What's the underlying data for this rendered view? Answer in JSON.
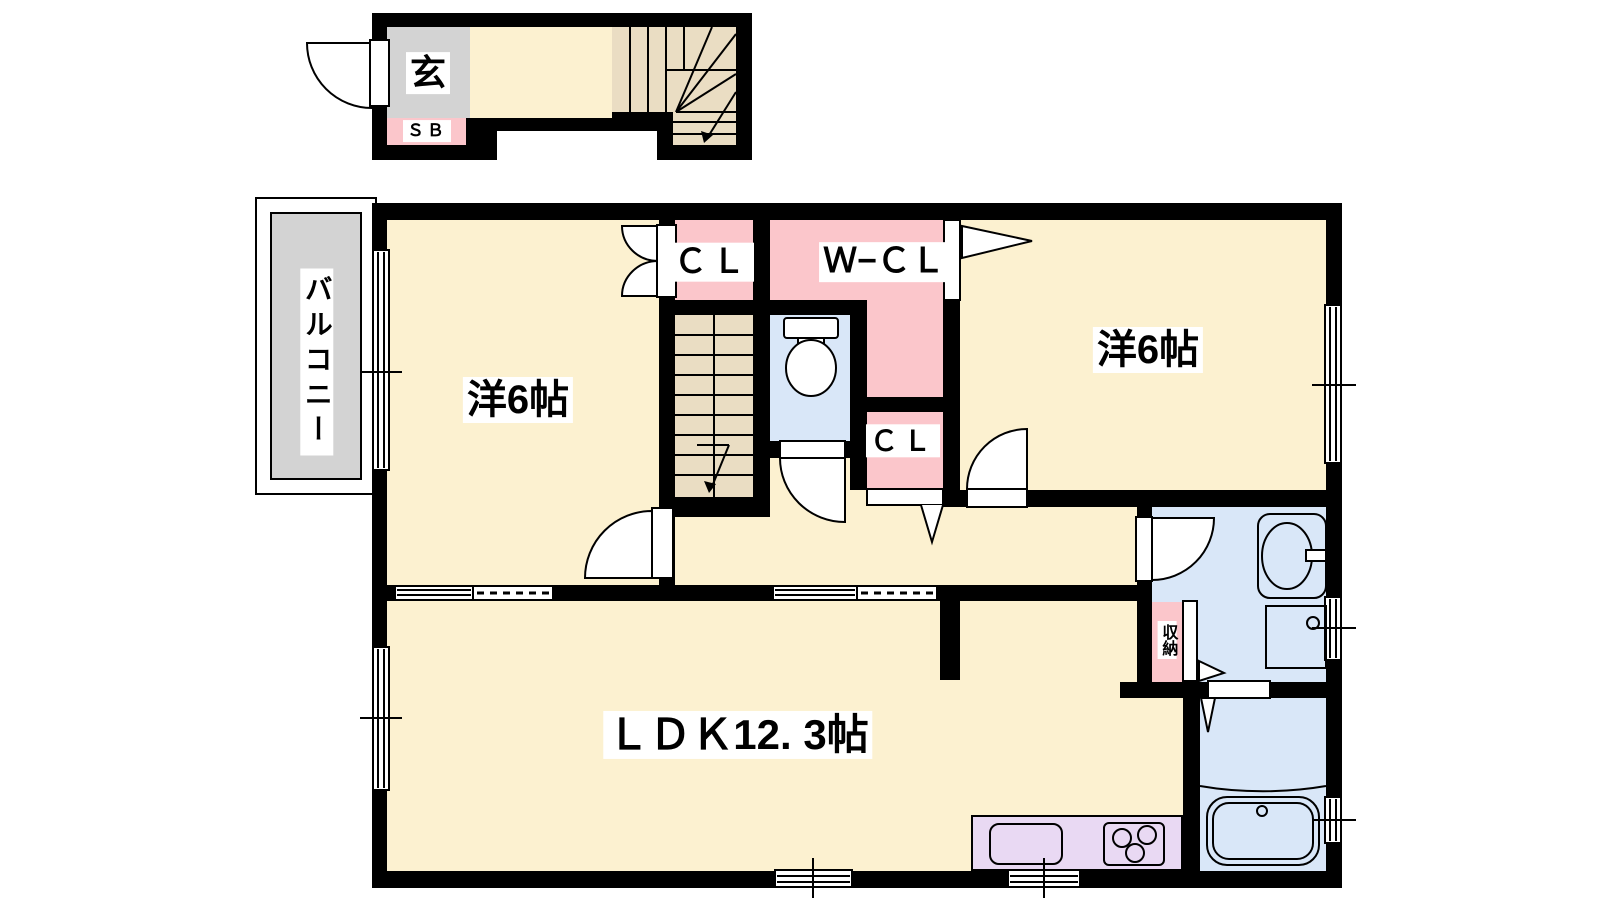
{
  "colors": {
    "page": "#FFFFFF",
    "wall": "#000000",
    "floor": "#FCF1D0",
    "stairs": "#EADDC3",
    "closet": "#FBC6CB",
    "wet": "#D9E7F8",
    "kitchen": "#E9D9F3",
    "balcony": "#D3D3D3"
  },
  "labels": {
    "entrance": "玄",
    "shoe_box": "ＳＢ",
    "balcony": "バルコニー",
    "west_room": "洋6帖",
    "east_room": "洋6帖",
    "closet_top": "ＣＬ",
    "walk_in_closet": "Ｗ−ＣＬ",
    "closet_mid": "ＣＬ",
    "storage": "収納",
    "ldk": "ＬＤＫ12. 3帖"
  }
}
